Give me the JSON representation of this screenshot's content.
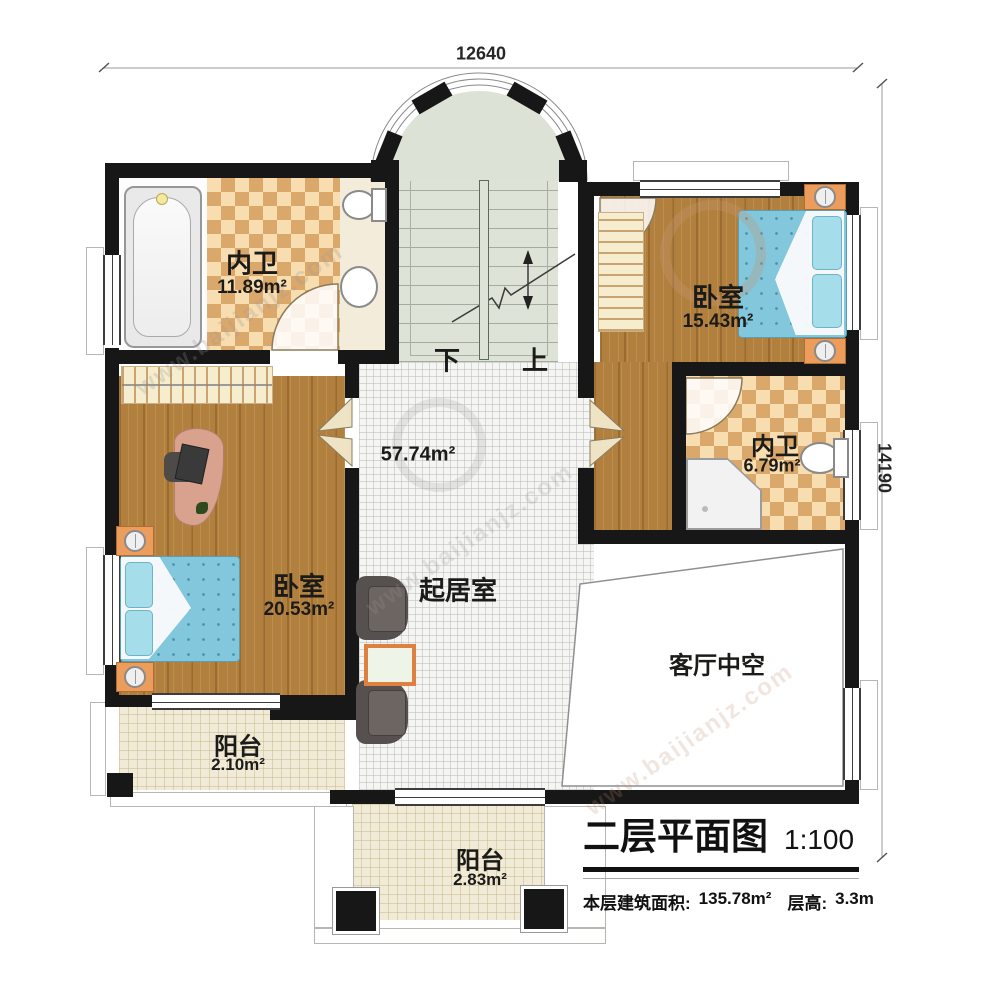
{
  "dimensions": {
    "width": "12640",
    "height": "14190"
  },
  "rooms": {
    "bath1": {
      "name": "内卫",
      "area": "11.89m²"
    },
    "bedroom1": {
      "name": "卧室",
      "area": "15.43m²"
    },
    "bath2": {
      "name": "内卫",
      "area": "6.79m²"
    },
    "bedroom2": {
      "name": "卧室",
      "area": "20.53m²"
    },
    "living": {
      "name": "起居室",
      "area": "57.74m²"
    },
    "void": {
      "name": "客厅中空"
    },
    "balcony1": {
      "name": "阳台",
      "area": "2.10m²"
    },
    "balcony2": {
      "name": "阳台",
      "area": "2.83m²"
    }
  },
  "stairs": {
    "down": "下",
    "up": "上"
  },
  "title_block": {
    "title": "二层平面图",
    "scale": "1:100",
    "floor_area_label": "本层建筑面积:",
    "floor_area": "135.78m²",
    "floor_height_label": "层高:",
    "floor_height": "3.3m"
  },
  "watermark": {
    "text": "www.baijianjz.com"
  },
  "colors": {
    "wall": "#171717",
    "wood_floor": "#b2803e",
    "tile_checker": "#dba86b",
    "stairwell": "#dde3d7",
    "bed_blue": "#82c7dc",
    "furniture_orange": "#ec9c5b"
  }
}
